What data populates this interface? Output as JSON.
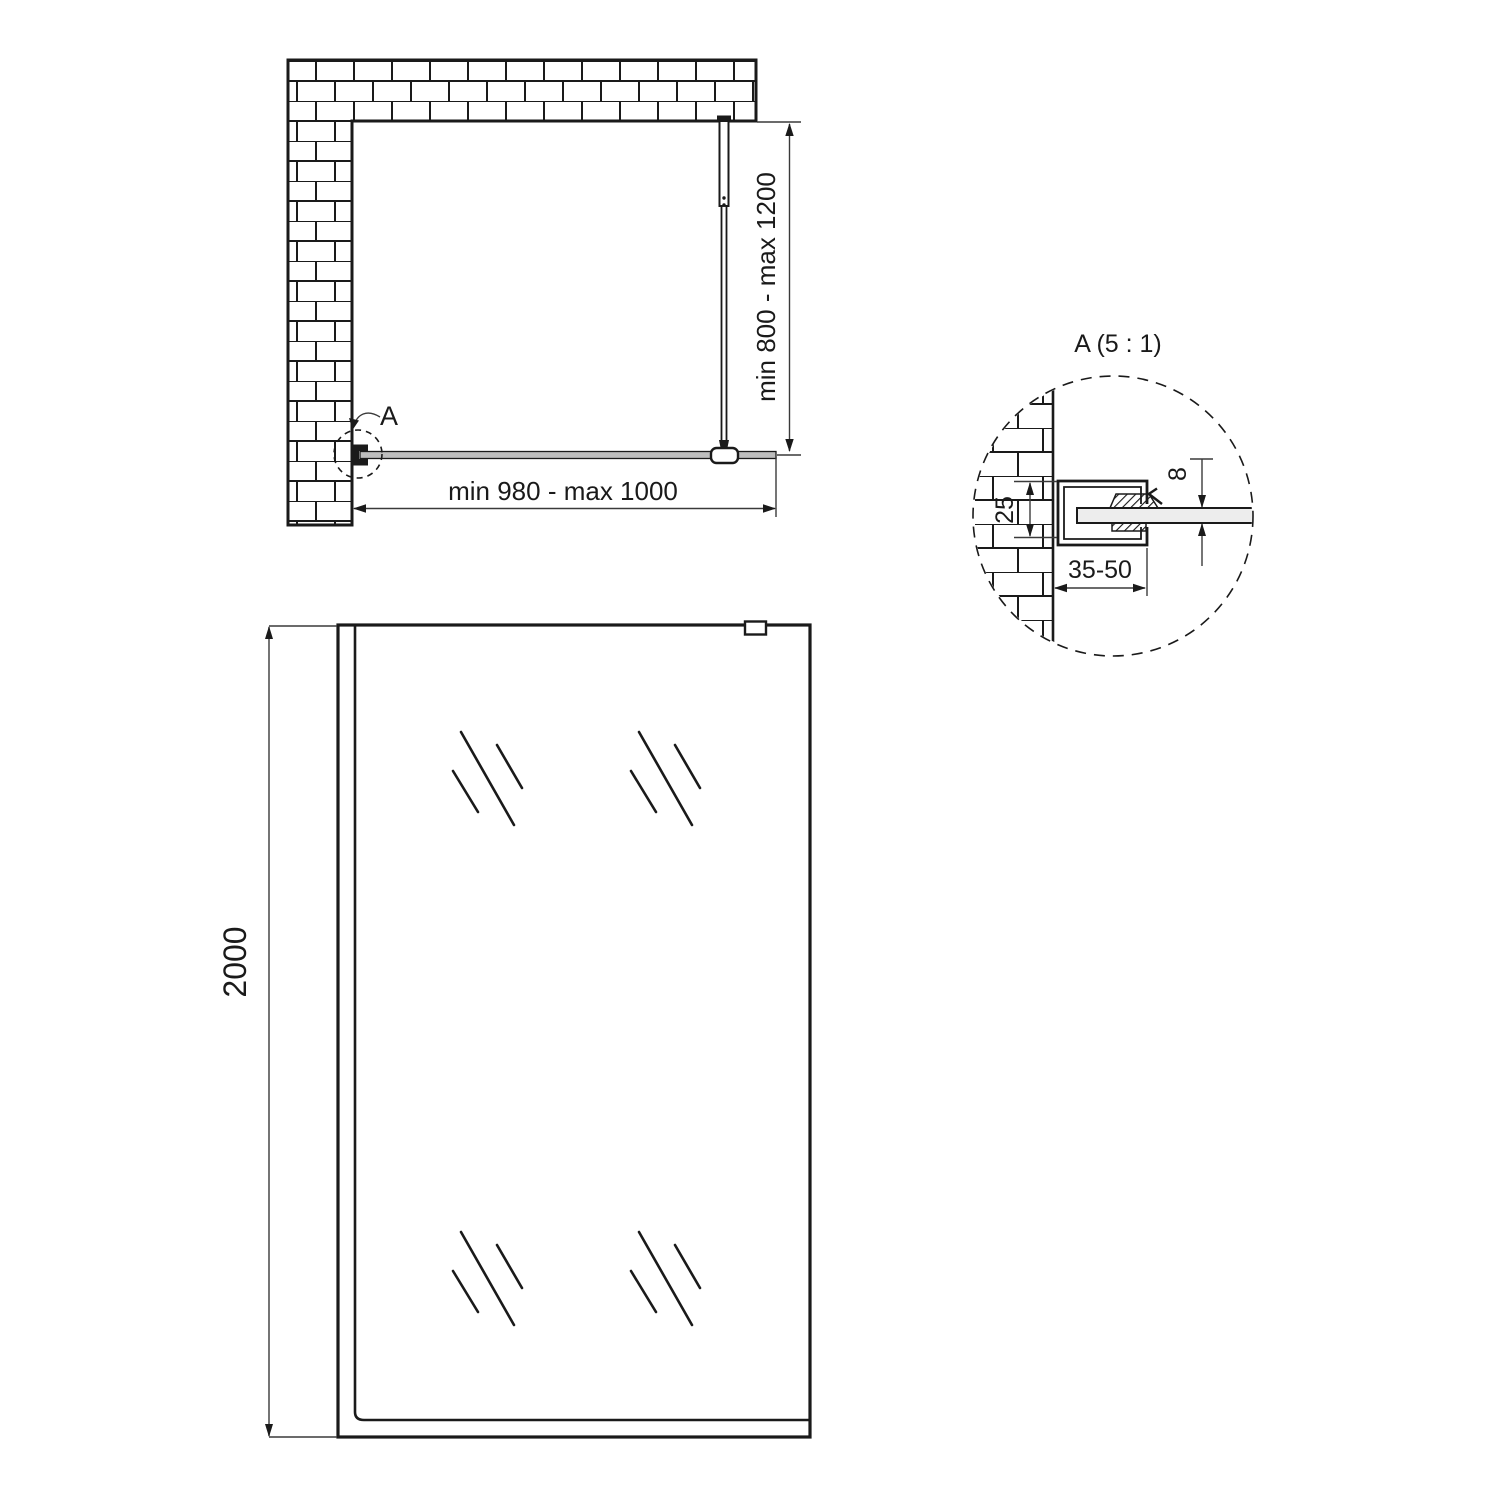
{
  "page": {
    "background": "#ffffff"
  },
  "drawing": {
    "ink_color": "#1a1a1a",
    "plan_view": {
      "detail_marker_label": "A",
      "width_dimension": "min 980 - max 1000",
      "support_bar_dimension": "min 800 - max 1200"
    },
    "detail_view": {
      "title": "A (5 : 1)",
      "profile_height_dimension": "25",
      "glass_thickness_dimension": "8",
      "profile_depth_dimension": "35-50"
    },
    "front_view": {
      "height_dimension": "2000"
    }
  }
}
